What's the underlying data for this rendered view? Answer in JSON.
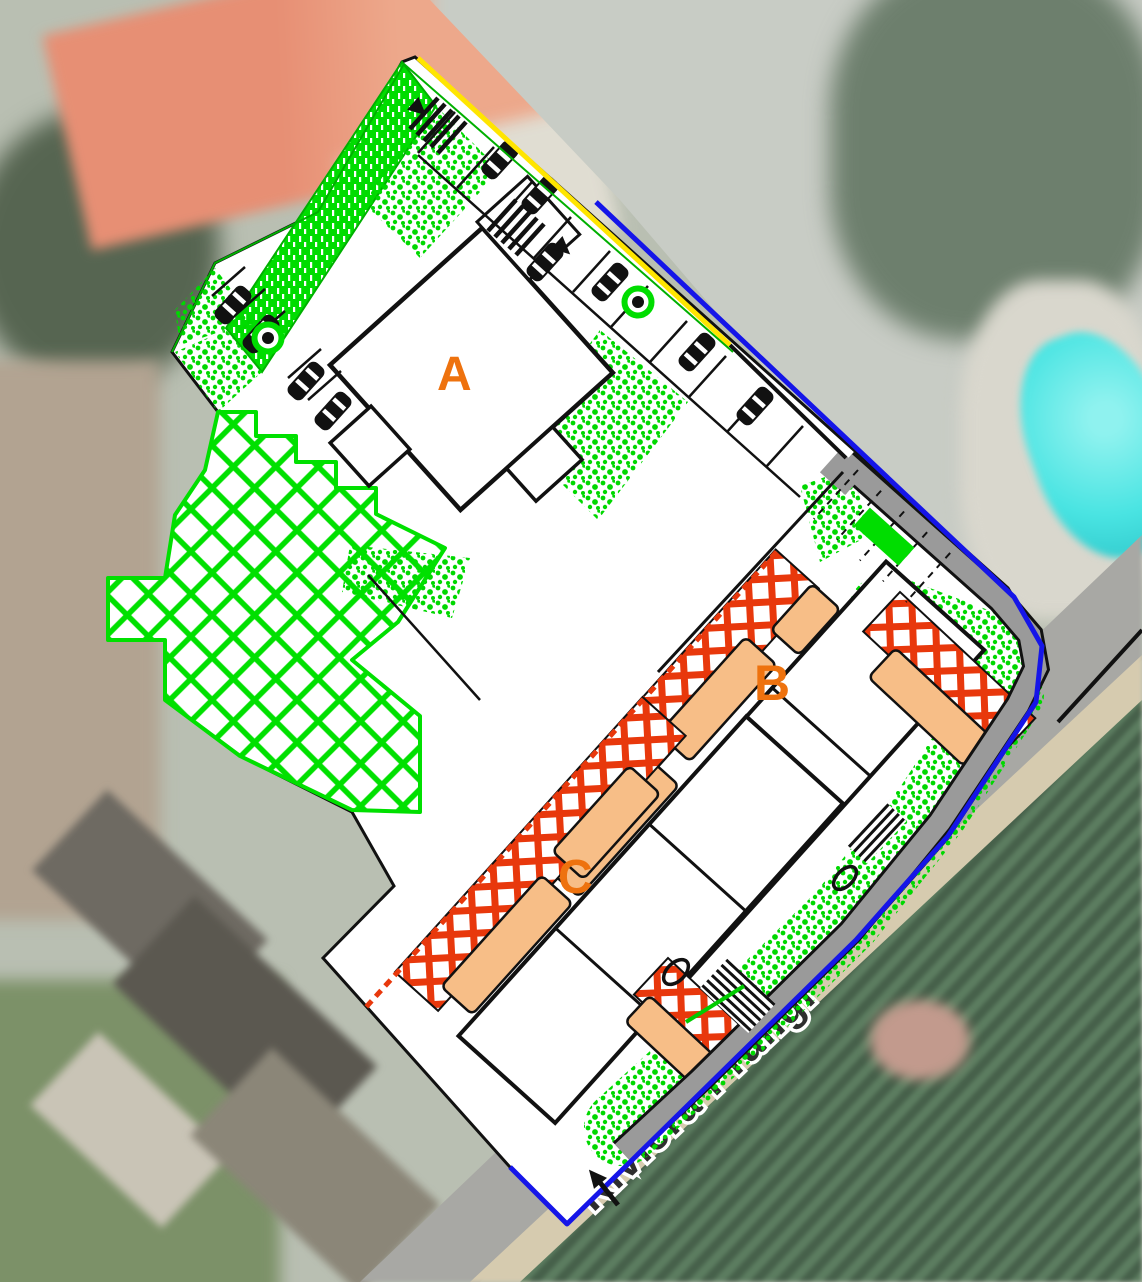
{
  "scene": {
    "description": "Architectural site plan (CAD overlay) placed over an aerial satellite photo",
    "street": {
      "name": "Riviera Prangi"
    },
    "building_labels": [
      {
        "id": "building-a",
        "label": "A"
      },
      {
        "id": "building-b",
        "label": "B"
      },
      {
        "id": "building-c",
        "label": "C"
      }
    ],
    "colors": {
      "label_orange": "#ee720e",
      "boundary_blue": "#1515e8",
      "boundary_yellow": "#ffe500",
      "boundary_green": "#00b000",
      "vegetation_stipple_green": "#00d800",
      "hatch_bright_green": "#00e000",
      "terrace_crosshatch_red": "#e8380c",
      "balcony_peach": "#f7be87",
      "sidewalk_gray": "#9a9a9a",
      "pool_cyan": "#49e4e2",
      "plan_line_black": "#111111"
    },
    "icons": [
      {
        "name": "car-icon",
        "glyph": "black plan-view car symbol"
      },
      {
        "name": "tree-icon",
        "glyph": "green ring with black center dot"
      },
      {
        "name": "arrow-icon",
        "glyph": "black triangle direction arrow"
      }
    ]
  }
}
